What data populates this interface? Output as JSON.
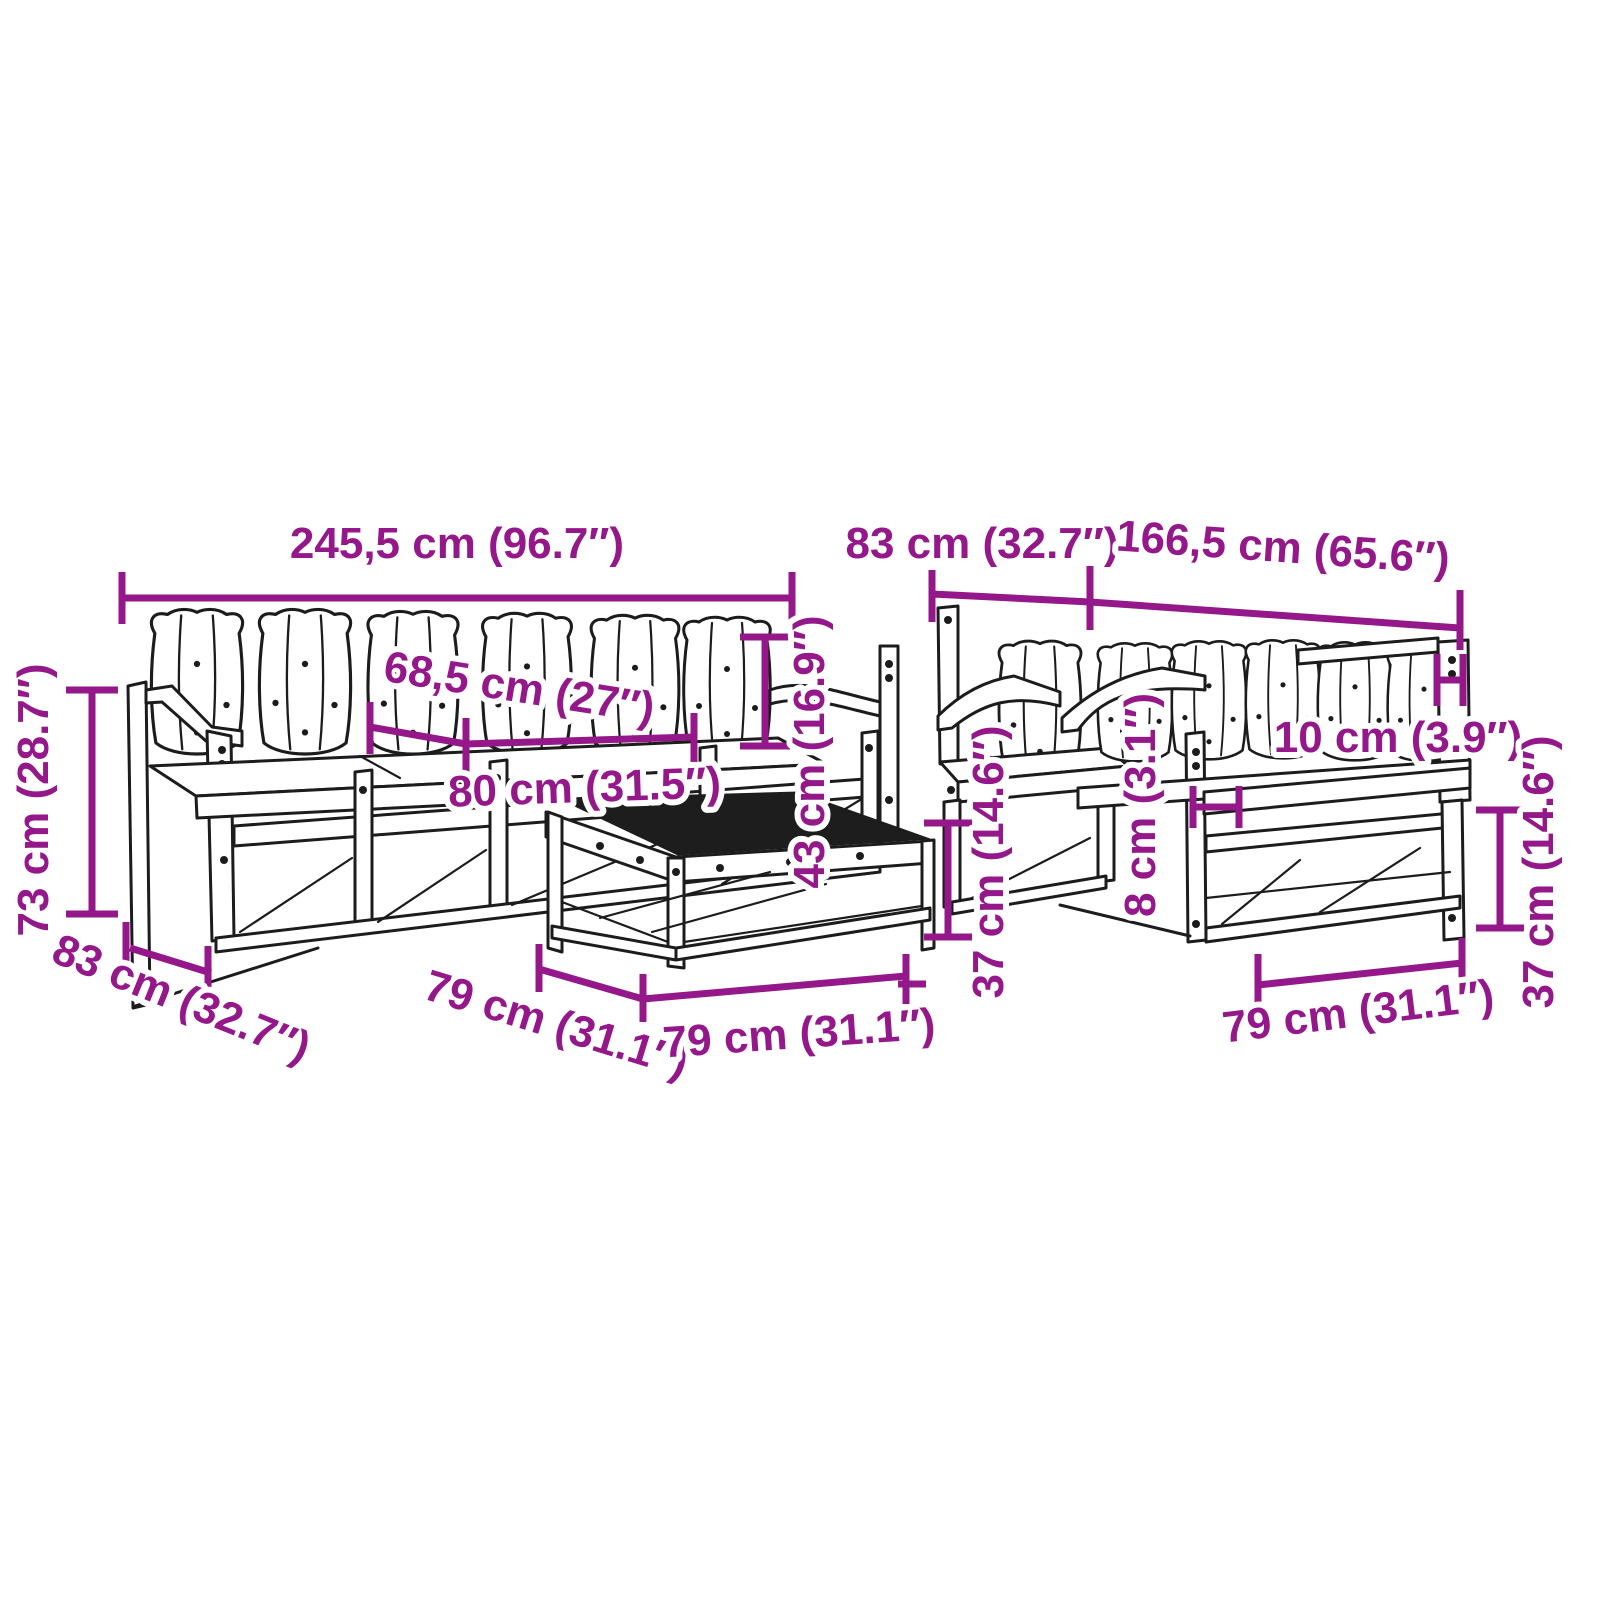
{
  "diagram": {
    "type": "furniture-dimension-diagram",
    "pieces": [
      "three-seater-garden-sofa",
      "coffee-table",
      "garden-armchair",
      "two-seater-garden-sofa"
    ]
  },
  "dimensions": {
    "overall_width": "245,5 cm (96.7″)",
    "seat_depth_top": "83 cm (32.7″)",
    "two_seater_width": "166,5 cm (65.6″)",
    "cushion_width": "68,5 cm (27″)",
    "overall_height": "73 cm (28.7″)",
    "seat_width": "80 cm (31.5″)",
    "backrest_height": "43 cm (16.9″)",
    "sofa_depth": "83 cm (32.7″)",
    "table_depth": "79 cm (31.1″)",
    "table_width": "79 cm (31.1″)",
    "table_height": "37 cm (14.6″)",
    "armrest_gap": "10 cm (3.9″)",
    "plank_thickness": "8 cm (3.1″)",
    "seat_module_width": "79 cm (31.1″)",
    "base_height": "37 cm (14.6″)"
  },
  "colors": {
    "dimension_accent": "#94188A",
    "line_art": "#1c1c1c",
    "table_top_fill": "#1d1d1d",
    "background": "#ffffff"
  }
}
